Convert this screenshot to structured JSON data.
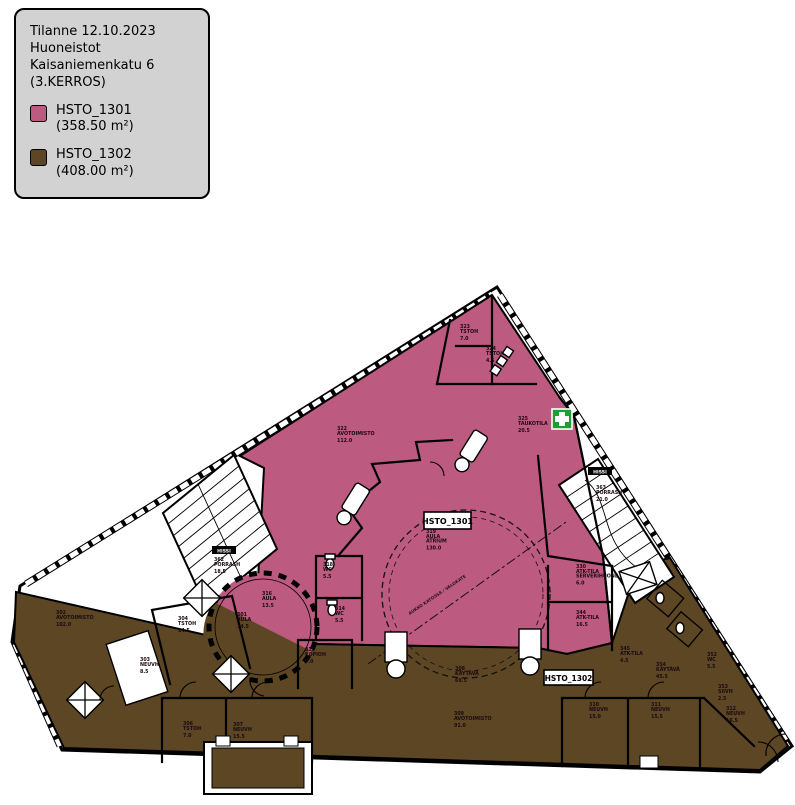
{
  "legend": {
    "title_lines": [
      "Tilanne 12.10.2023",
      "Huoneistot",
      "Kaisaniemenkatu 6",
      "(3.KERROS)"
    ],
    "items": [
      {
        "label": "HSTO_1301 (358.50 m²)",
        "color_key": "unit_1301"
      },
      {
        "label": "HSTO_1302 (408.00 m²)",
        "color_key": "unit_1302"
      }
    ]
  },
  "plan": {
    "colors": {
      "unit_1301": "#bd5a80",
      "unit_1302": "#5c4624",
      "first_aid_green": "#18a12f",
      "legend_bg": "#d2d2d2",
      "wall": "#000000"
    },
    "unit_tags": [
      {
        "label": "HSTO_1301"
      },
      {
        "label": "HSTO_1302"
      }
    ],
    "elevator_label": "HISSI",
    "atrium_note": "AUKKO KATOSSA / VALOKATE",
    "rooms": [
      {
        "x": 460,
        "y": 328,
        "lines": [
          "323",
          "TSTOH",
          "7.0"
        ]
      },
      {
        "x": 486,
        "y": 350,
        "lines": [
          "324",
          "TSTOH",
          "4.5"
        ]
      },
      {
        "x": 518,
        "y": 420,
        "lines": [
          "325",
          "TAUKOTILA",
          "20.5"
        ]
      },
      {
        "x": 337,
        "y": 430,
        "lines": [
          "322",
          "AVOTOIMISTO",
          "112.0"
        ]
      },
      {
        "x": 426,
        "y": 533,
        "lines": [
          "319",
          "AULA",
          "ATRIUM",
          "130.0"
        ]
      },
      {
        "x": 576,
        "y": 568,
        "lines": [
          "330",
          "ATK-TILA",
          "SERVERIHUONE",
          "6.0"
        ]
      },
      {
        "x": 576,
        "y": 614,
        "lines": [
          "344",
          "ATK-TILA",
          "16.5"
        ]
      },
      {
        "x": 262,
        "y": 595,
        "lines": [
          "316",
          "AULA",
          "13.5"
        ]
      },
      {
        "x": 323,
        "y": 566,
        "lines": [
          "318",
          "WC",
          "5.5"
        ]
      },
      {
        "x": 56,
        "y": 614,
        "lines": [
          "302",
          "AVOTOIMISTO",
          "102.0"
        ]
      },
      {
        "x": 178,
        "y": 620,
        "lines": [
          "304",
          "TSTOH",
          "14.5"
        ]
      },
      {
        "x": 140,
        "y": 661,
        "lines": [
          "303",
          "NEUVH",
          "8.5"
        ]
      },
      {
        "x": 237,
        "y": 616,
        "lines": [
          "301",
          "AULA",
          "14.5"
        ]
      },
      {
        "x": 455,
        "y": 670,
        "lines": [
          "308",
          "KÄYTÄVÄ",
          "69.5"
        ]
      },
      {
        "x": 454,
        "y": 715,
        "lines": [
          "309",
          "AVOTOIMISTO",
          "91.0"
        ]
      },
      {
        "x": 183,
        "y": 725,
        "lines": [
          "306",
          "TSTOH",
          "7.0"
        ]
      },
      {
        "x": 233,
        "y": 726,
        "lines": [
          "307",
          "NEUVH",
          "15.5"
        ]
      },
      {
        "x": 589,
        "y": 706,
        "lines": [
          "310",
          "NEUVH",
          "15.0"
        ]
      },
      {
        "x": 651,
        "y": 706,
        "lines": [
          "311",
          "NEUVH",
          "15.5"
        ]
      },
      {
        "x": 726,
        "y": 710,
        "lines": [
          "312",
          "NEUVH",
          "16.5"
        ]
      },
      {
        "x": 656,
        "y": 666,
        "lines": [
          "354",
          "KÄYTÄVÄ",
          "45.5"
        ]
      },
      {
        "x": 707,
        "y": 656,
        "lines": [
          "352",
          "WC",
          "5.5"
        ]
      },
      {
        "x": 718,
        "y": 688,
        "lines": [
          "353",
          "SIIVH",
          "2.5"
        ]
      },
      {
        "x": 335,
        "y": 610,
        "lines": [
          "314",
          "WC",
          "5.5"
        ]
      },
      {
        "x": 305,
        "y": 651,
        "lines": [
          "315",
          "KOPIOH",
          "7.0"
        ]
      },
      {
        "x": 620,
        "y": 650,
        "lines": [
          "345",
          "ATK-TILA",
          "4.5"
        ]
      },
      {
        "x": 214,
        "y": 561,
        "lines": [
          "362",
          "PORRASH",
          "18.5"
        ]
      },
      {
        "x": 596,
        "y": 489,
        "lines": [
          "363",
          "PORRASH",
          "21.0"
        ]
      }
    ]
  }
}
